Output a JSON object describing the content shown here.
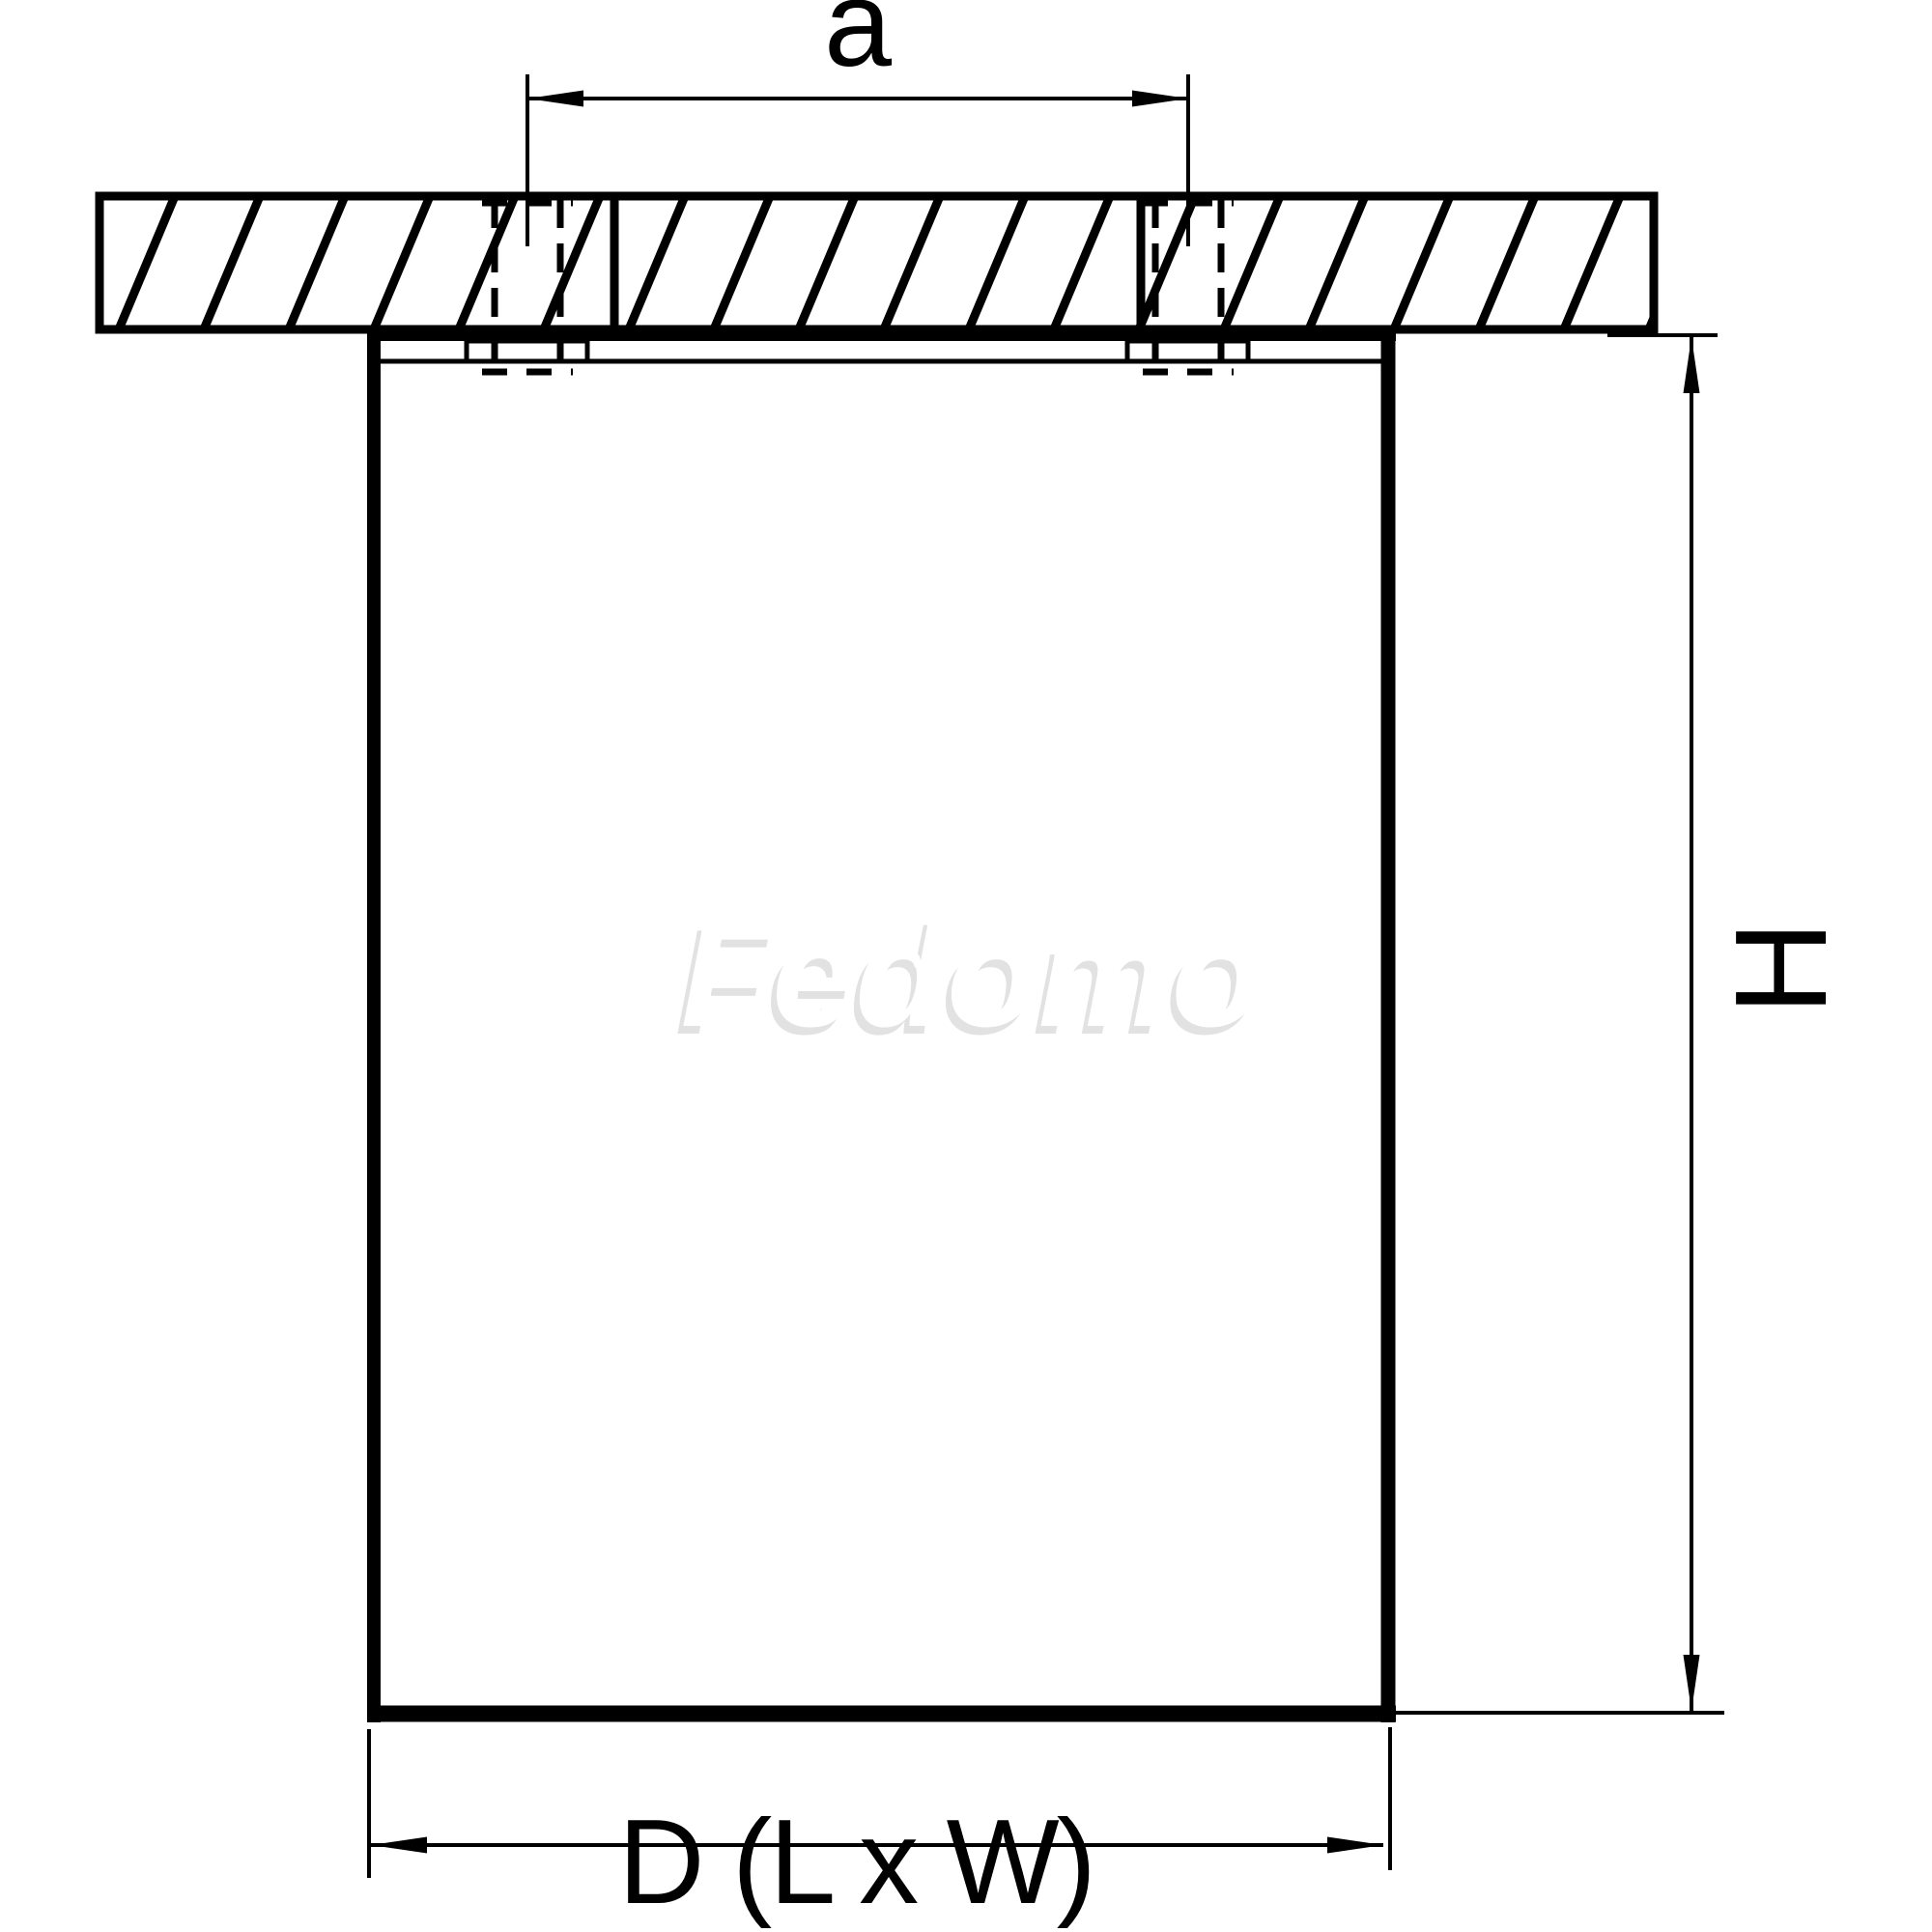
{
  "labels": {
    "top_dimension": "a",
    "height_dimension": "H",
    "bottom_dimension": "D (L x W)"
  },
  "watermark": {
    "text": "Fedomo"
  },
  "colors": {
    "line": "#000000",
    "background": "#ffffff",
    "watermark_fill": "#ffffff",
    "watermark_shadow": "#e2e2e2"
  }
}
